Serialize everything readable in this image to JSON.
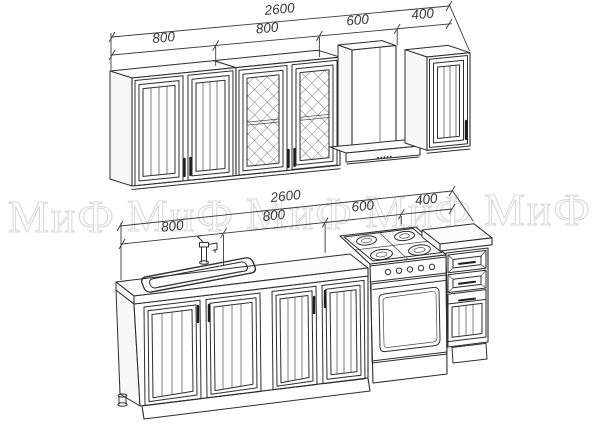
{
  "watermark": {
    "text": "МиФ",
    "color": "#d8d8d8",
    "repeats": 5
  },
  "dimensions": {
    "top_row": {
      "overall": "2600",
      "segments": [
        "800",
        "800",
        "600",
        "400"
      ]
    },
    "bottom_row": {
      "overall": "2600",
      "segments": [
        "800",
        "800",
        "600",
        "400"
      ]
    }
  },
  "drawing": {
    "line_color": "#2e2e2e",
    "background": "#ffffff",
    "upper_units": [
      {
        "name": "wall cabinet, two panel doors",
        "width": "800"
      },
      {
        "name": "wall cabinet, lattice glass doors",
        "width": "800"
      },
      {
        "name": "cooker hood with chimney",
        "width": "600"
      },
      {
        "name": "wall cabinet, single panel door",
        "width": "400"
      }
    ],
    "lower_units": [
      {
        "name": "sink base cabinet with faucet",
        "width": "800"
      },
      {
        "name": "base cabinet, two panel doors",
        "width": "800"
      },
      {
        "name": "gas stove with oven",
        "width": "600"
      },
      {
        "name": "base cabinet with drawers",
        "width": "400"
      }
    ]
  }
}
